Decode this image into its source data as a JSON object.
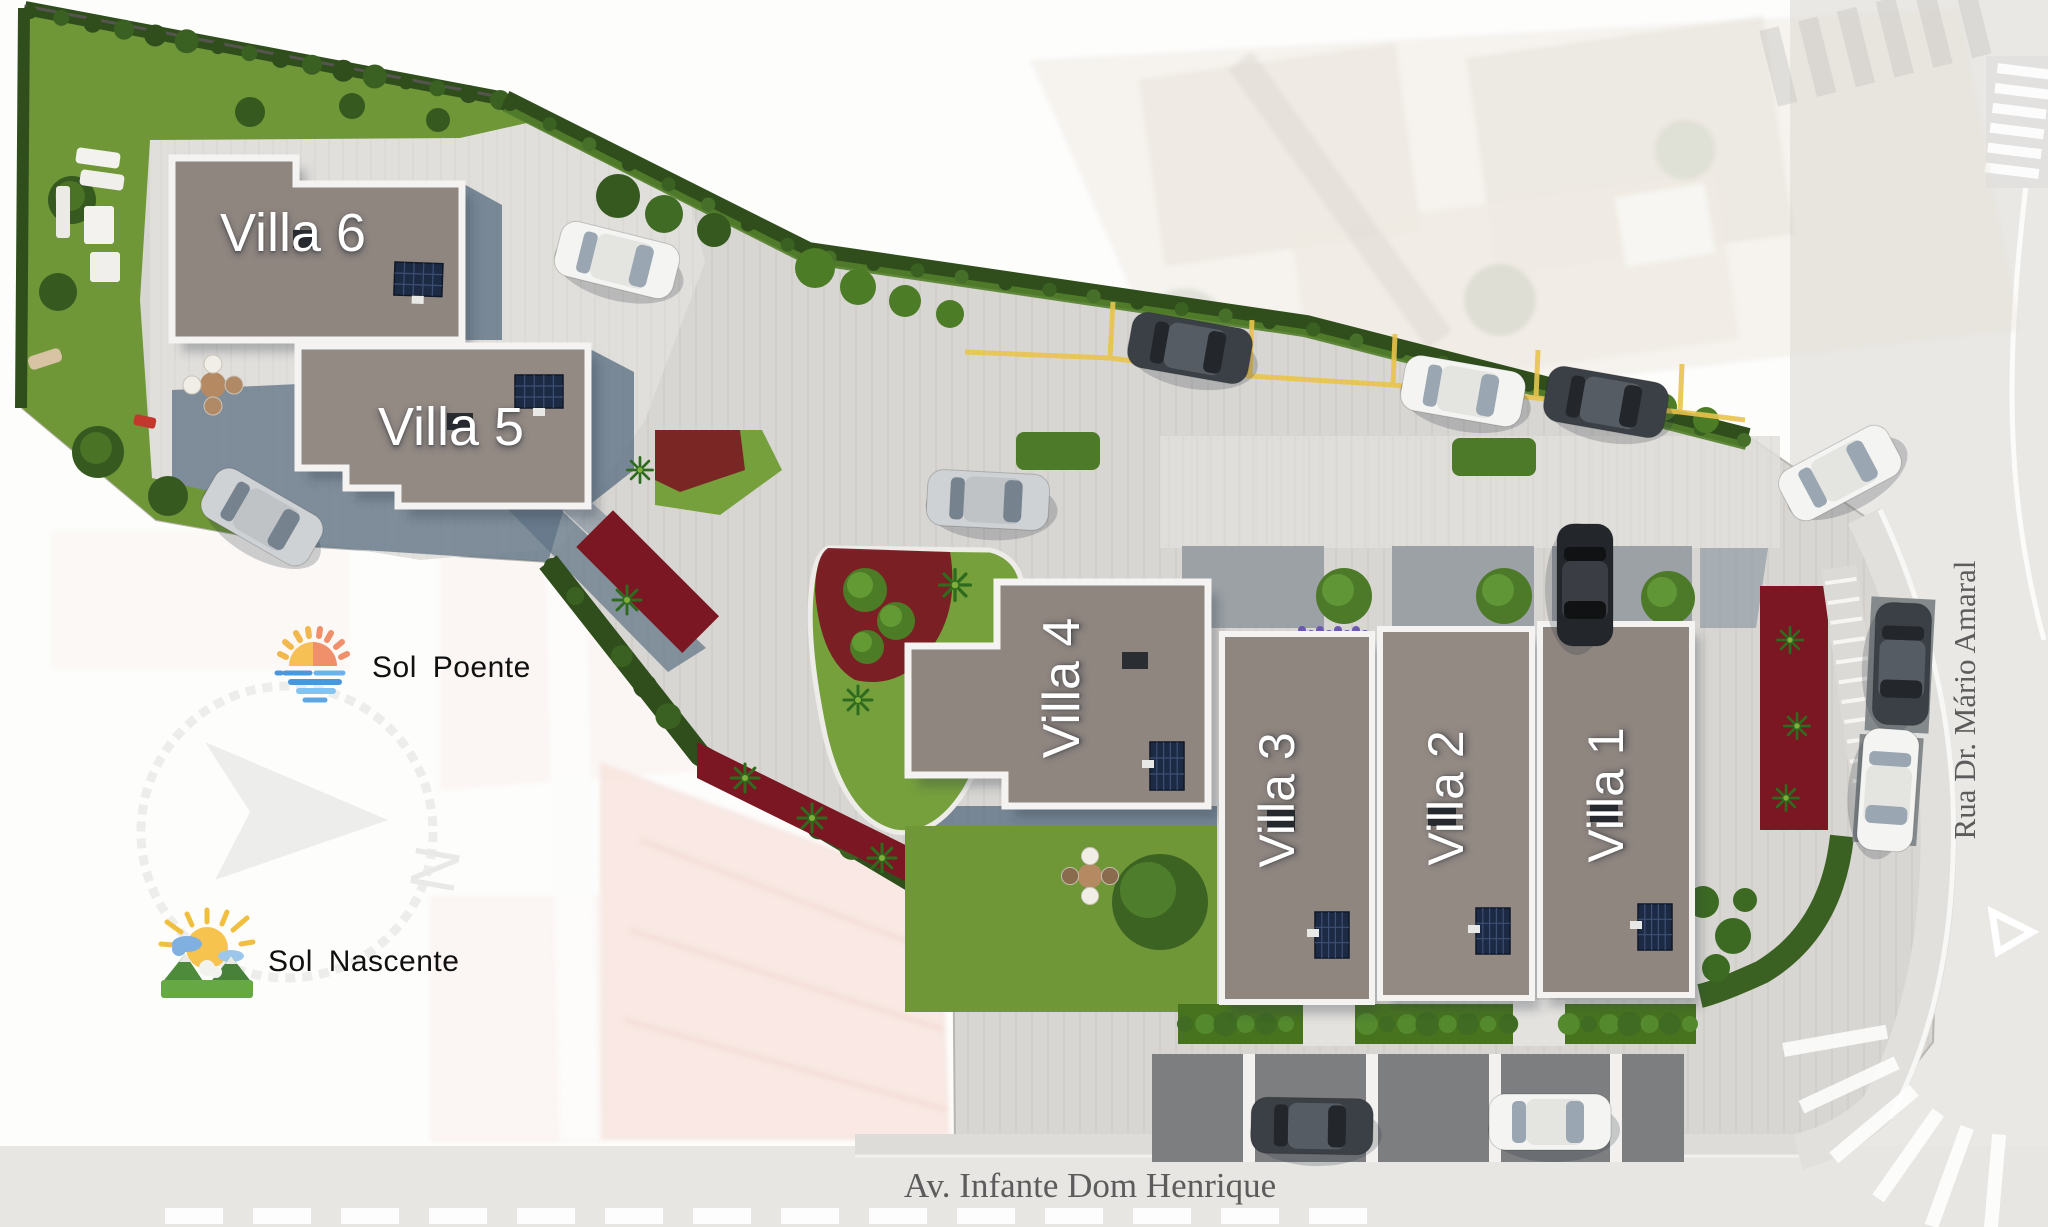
{
  "plan": {
    "title": "Villa development site plan",
    "villas": [
      {
        "id": "villa-1",
        "label": "Villa 1"
      },
      {
        "id": "villa-2",
        "label": "Villa 2"
      },
      {
        "id": "villa-3",
        "label": "Villa 3"
      },
      {
        "id": "villa-4",
        "label": "Villa 4"
      },
      {
        "id": "villa-5",
        "label": "Villa 5"
      },
      {
        "id": "villa-6",
        "label": "Villa 6"
      }
    ],
    "legend": {
      "sunset": {
        "label": "Sol Poente",
        "icon": "sunset-over-water-icon"
      },
      "sunrise": {
        "label": "Sol Nascente",
        "icon": "sunrise-over-mountains-icon"
      }
    },
    "compass": {
      "icon": "compass-north-arrow-icon",
      "north_label": "N"
    },
    "streets": {
      "bottom": "Av. Infante Dom Henrique",
      "right": "Rua Dr. Mário Amaral"
    },
    "colors": {
      "roof": "#8f8680",
      "roof_border": "#f4f3f1",
      "paving": "#d8d6d2",
      "patio": "#e0deda",
      "lawn": "#6f9738",
      "hedge": "#2f4e1c",
      "shrub_red": "#7a1722",
      "wall_shadow": "#5e7284",
      "parking_line": "#e9c44c",
      "villa_label_text": "#ffffff",
      "street_text": "#5c5c5c"
    }
  }
}
